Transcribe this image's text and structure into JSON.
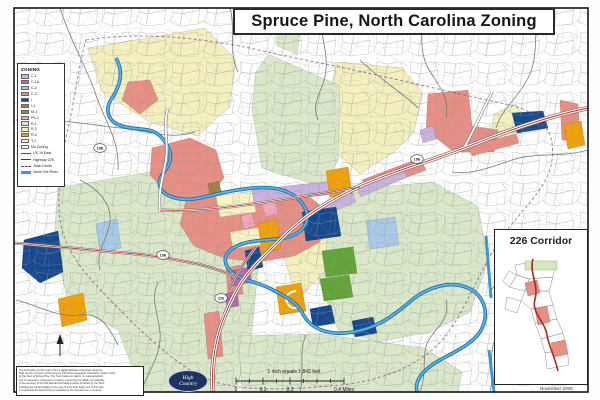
{
  "title": "Spruce Pine, North Carolina Zoning",
  "legend": {
    "title": "ZONING",
    "items": [
      {
        "label": "C-1",
        "color": "#c9b3de"
      },
      {
        "label": "C-1A",
        "color": "#b468b0"
      },
      {
        "label": "C-2",
        "color": "#a9c9e9"
      },
      {
        "label": "C-3",
        "color": "#e78f84"
      },
      {
        "label": "I",
        "color": "#17498f"
      },
      {
        "label": "I-1",
        "color": "#9f8040"
      },
      {
        "label": "M-1",
        "color": "#63a437"
      },
      {
        "label": "PS-1",
        "color": "#f0a8bc"
      },
      {
        "label": "R-1",
        "color": "#dae7c8"
      },
      {
        "label": "R-2",
        "color": "#f3efbe"
      },
      {
        "label": "R-3",
        "color": "#f2a007"
      },
      {
        "label": "T-1",
        "color": "#f8f4c8"
      },
      {
        "label": "No Zoning",
        "color": "#ffffff"
      }
    ],
    "lines": [
      {
        "label": "US 19 East",
        "color": "#c5271c"
      },
      {
        "label": "Highway 226",
        "color": "#8e1f1a"
      },
      {
        "label": "Town Limits",
        "color": "#7a3b8f"
      },
      {
        "label": "North Toe River",
        "color": "#3d97d3"
      }
    ]
  },
  "shields": {
    "s1": "19E",
    "s2": "19E",
    "s3": "226",
    "s4": "19E"
  },
  "inset": {
    "title": "226 Corridor"
  },
  "scalebar": {
    "caption": "1 inch equals 1,842 feet",
    "tick0": "0",
    "tick1": "0.1",
    "tick2": "0.2",
    "tick3": "0.4 Miles"
  },
  "footer": {
    "date": "November 2006",
    "logo_line1": "High",
    "logo_line2": "Country",
    "disclaimer_lines": [
      "The information on this map is from a digital database assembled using the",
      "High Country Council of Governments (HCCOG) Geographic Information System (GIS)",
      "by the Town of Spruce Pine. The Town makes no claims, no representations",
      "and no warranties, expressed or implied, concerning the validity, the reliability",
      "or the accuracy of the GIS data and GIS data products furnished by the Town,",
      "including the implied validity of any uses of such data. Each user of this map",
      "is responsible for determining its suitability for the intended use or purpose."
    ]
  }
}
